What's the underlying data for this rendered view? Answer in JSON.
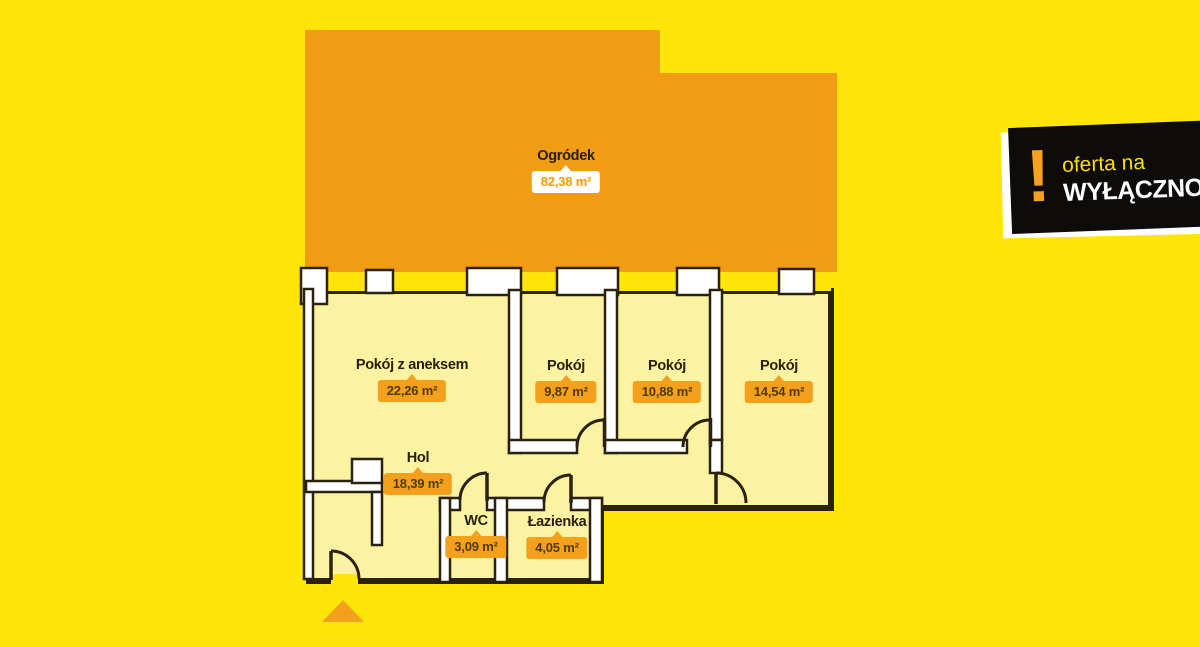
{
  "plan": {
    "garden": {
      "label": "Ogródek",
      "area": "82,38 m²"
    },
    "rooms": [
      {
        "label": "Pokój z aneksem",
        "area": "22,26 m²"
      },
      {
        "label": "Pokój",
        "area": "9,87 m²"
      },
      {
        "label": "Pokój",
        "area": "10,88 m²"
      },
      {
        "label": "Pokój",
        "area": "14,54 m²"
      },
      {
        "label": "Hol",
        "area": "18,39 m²"
      },
      {
        "label": "WC",
        "area": "3,09 m²"
      },
      {
        "label": "Łazienka",
        "area": "4,05 m²"
      }
    ]
  },
  "sticker": {
    "exclamation": "!",
    "line1": "oferta na",
    "line2": "WYŁĄCZNOŚĆ"
  },
  "colors": {
    "background": "#ffe50a",
    "garden": "#f09c15",
    "room_fill": "#fbf2a2",
    "wall": "#2a210f",
    "badge_orange": "#f3a01d",
    "badge_text": "#503a08",
    "garden_badge_text": "#f59d00",
    "sticker_background": "#0d0c0a",
    "sticker_accent": "#f5a01e",
    "sticker_line1_color": "#ffdf00",
    "sticker_line2_color": "#ffffff"
  }
}
